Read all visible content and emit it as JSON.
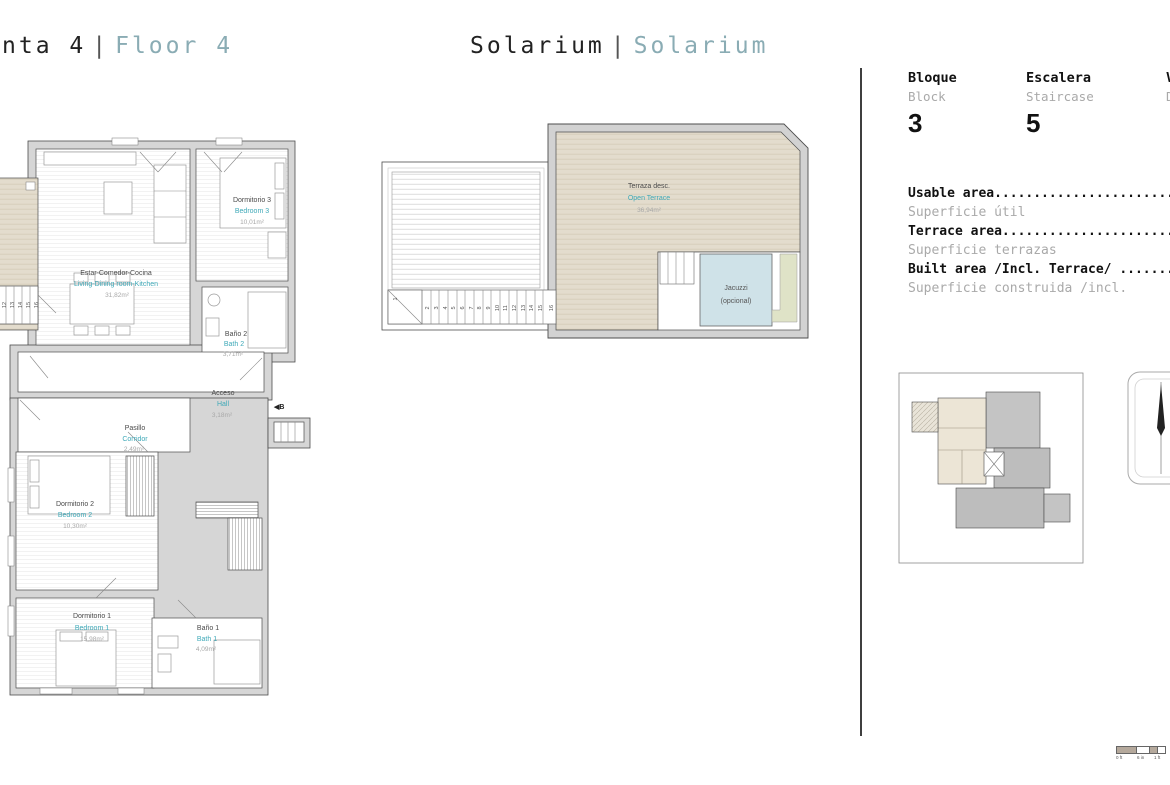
{
  "titles": {
    "left": {
      "part1": "nta 4",
      "sep": "|",
      "part2": "Floor 4"
    },
    "center": {
      "part1": "Solarium",
      "sep": "|",
      "part2": "Solarium"
    }
  },
  "info": {
    "fields": [
      {
        "label_es": "Bloque",
        "label_en": "Block",
        "value": "3"
      },
      {
        "label_es": "Escalera",
        "label_en": "Staircase",
        "value": "5"
      },
      {
        "label_es": "Vivienda",
        "label_en": "Dwelling",
        "value": ""
      }
    ],
    "areas": [
      {
        "bold": "Usable area.........................",
        "gray": "Superficie útil"
      },
      {
        "bold": "Terrace area........................",
        "gray": "Superficie terrazas"
      },
      {
        "bold": "Built area /Incl. Terrace/ .........",
        "gray": "Superficie construida /incl. "
      }
    ]
  },
  "plan": {
    "rooms": {
      "living": {
        "es": "Estar-Comedor-Cocina",
        "en": "Living-Dining room-Kitchen",
        "area": "31,82m²"
      },
      "bedroom3": {
        "es": "Dormitorio 3",
        "en": "Bedroom 3",
        "area": "10,01m²"
      },
      "bath2": {
        "es": "Baño 2",
        "en": "Bath 2",
        "area": "3,71m²"
      },
      "hall": {
        "es": "Acceso",
        "en": "Hall",
        "area": "3,18m²"
      },
      "corridor": {
        "es": "Pasillo",
        "en": "Corridor",
        "area": "2,49m²"
      },
      "bedroom2": {
        "es": "Dormitorio 2",
        "en": "Bedroom 2",
        "area": "10,30m²"
      },
      "bedroom1": {
        "es": "Dormitorio 1",
        "en": "Bedroom 1",
        "area": "15,98m²"
      },
      "bath1": {
        "es": "Baño 1",
        "en": "Bath 1",
        "area": "4,09m²"
      }
    },
    "entrance_marker": "◀B",
    "left_stairs": [
      "12",
      "13",
      "14",
      "15",
      "16"
    ]
  },
  "sol": {
    "terrace": {
      "es": "Terraza desc.",
      "en": "Open Terrace",
      "area": "36,94m²"
    },
    "jacuzzi": {
      "l1": "Jacuzzi",
      "l2": "(opcional)"
    },
    "stairs": [
      "1",
      "2",
      "3",
      "4",
      "5",
      "6",
      "7",
      "8",
      "9",
      "10",
      "11",
      "12",
      "13",
      "14",
      "15",
      "16"
    ]
  },
  "scalebar": {
    "labels": [
      "0 ft",
      "6 in",
      "1 ft"
    ]
  },
  "colors": {
    "accent_teal": "#3fa9b8",
    "title_teal": "#8aacb4",
    "wall_gray": "#d6d6d6",
    "deck_beige": "#e3dccd",
    "jacuzzi_blue": "#cfe2e8",
    "strip_green": "#dfe3c7"
  }
}
